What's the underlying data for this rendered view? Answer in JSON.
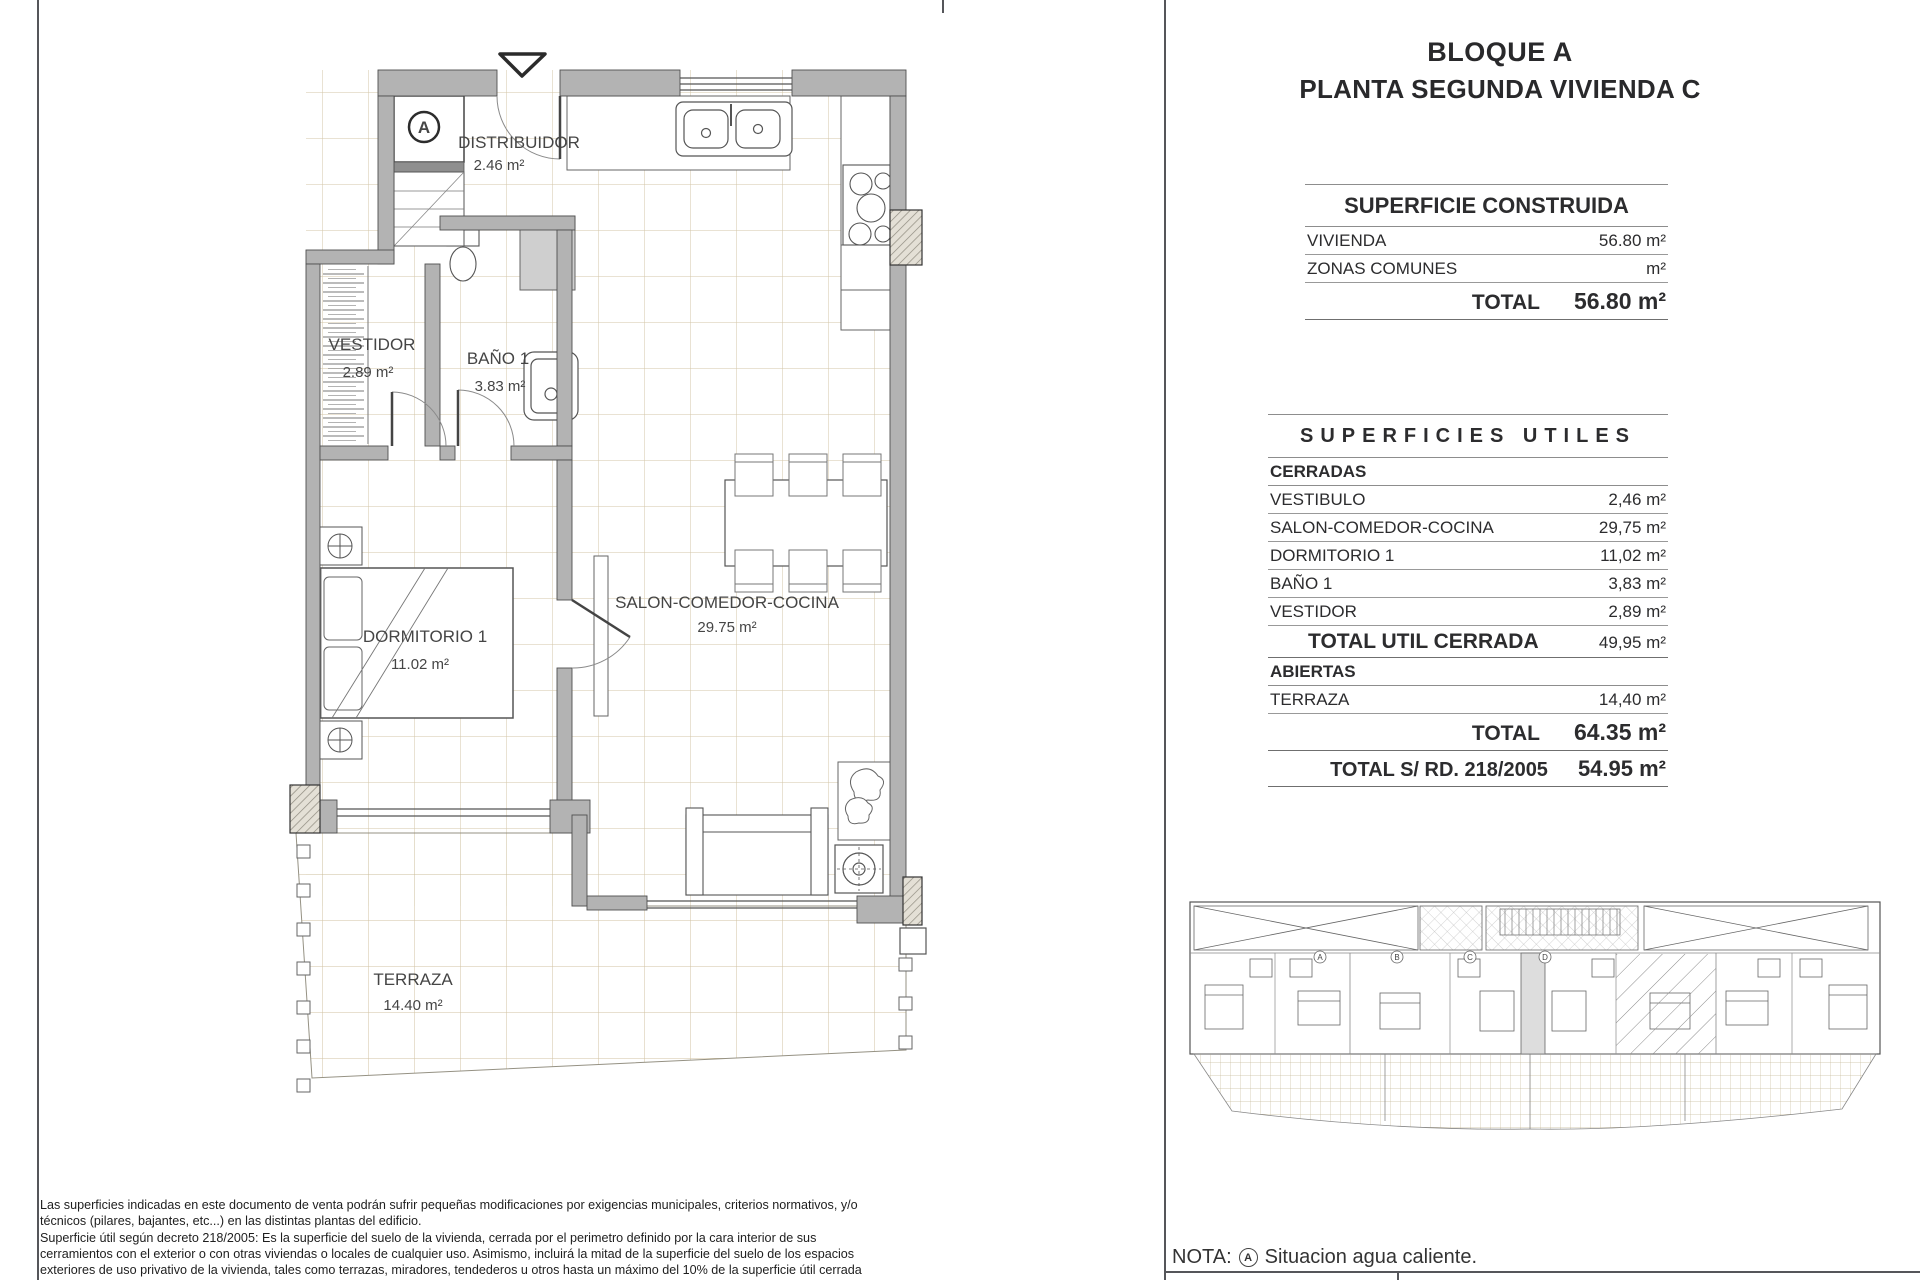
{
  "panel": {
    "title_line1": "BLOQUE A",
    "title_line2": "PLANTA SEGUNDA VIVIENDA C",
    "construida": {
      "header": "SUPERFICIE CONSTRUIDA",
      "rows": [
        {
          "label": "VIVIENDA",
          "value": "56.80 m²"
        },
        {
          "label": "ZONAS COMUNES",
          "value": "m²"
        }
      ],
      "total_label": "TOTAL",
      "total_value": "56.80 m²"
    },
    "utiles": {
      "header": "SUPERFICIES UTILES",
      "cerradas_label": "CERRADAS",
      "cerradas_rows": [
        {
          "label": "VESTIBULO",
          "value": "2,46 m²"
        },
        {
          "label": "SALON-COMEDOR-COCINA",
          "value": "29,75 m²"
        },
        {
          "label": "DORMITORIO 1",
          "value": "11,02 m²"
        },
        {
          "label": "BAÑO 1",
          "value": "3,83 m²"
        },
        {
          "label": "VESTIDOR",
          "value": "2,89 m²"
        }
      ],
      "total_cerrada_label": "TOTAL UTIL CERRADA",
      "total_cerrada_value": "49,95 m²",
      "abiertas_label": "ABIERTAS",
      "abiertas_rows": [
        {
          "label": "TERRAZA",
          "value": "14,40 m²"
        }
      ],
      "total_label": "TOTAL",
      "total_value": "64.35 m²",
      "total_rd_label": "TOTAL S/ RD. 218/2005",
      "total_rd_value": "54.95 m²"
    },
    "nota_prefix": "NOTA:",
    "nota_symbol": "A",
    "nota_text": "Situacion agua caliente."
  },
  "plan": {
    "hot_water_symbol": "A",
    "rooms": {
      "distribuidor": {
        "name": "DISTRIBUIDOR",
        "area": "2.46 m²"
      },
      "vestidor": {
        "name": "VESTIDOR",
        "area": "2.89 m²"
      },
      "bano": {
        "name": "BAÑO 1",
        "area": "3.83 m²"
      },
      "dormitorio": {
        "name": "DORMITORIO 1",
        "area": "11.02 m²"
      },
      "salon": {
        "name": "SALON-COMEDOR-COCINA",
        "area": "29.75 m²"
      },
      "terraza": {
        "name": "TERRAZA",
        "area": "14.40 m²"
      }
    }
  },
  "site_plan": {
    "markers": [
      "A",
      "B",
      "C",
      "D"
    ]
  },
  "disclaimer": "Las superficies indicadas en este documento de venta podrán sufrir pequeñas modificaciones por exigencias municipales, criterios normativos, y/o\ntécnicos (pilares, bajantes, etc...) en las distintas plantas del edificio.\nSuperficie útil según decreto 218/2005: Es la superficie del suelo de la vivienda, cerrada por el perimetro definido por la cara interior de sus\ncerramientos con el exterior o con otras viviendas o locales de cualquier uso. Asimismo, incluirá la mitad de la superficie del suelo de los espacios\nexteriores de uso privativo de la vivienda, tales como terrazas, miradores, tendederos u otros hasta un máximo del 10% de la superficie útil cerrada"
}
